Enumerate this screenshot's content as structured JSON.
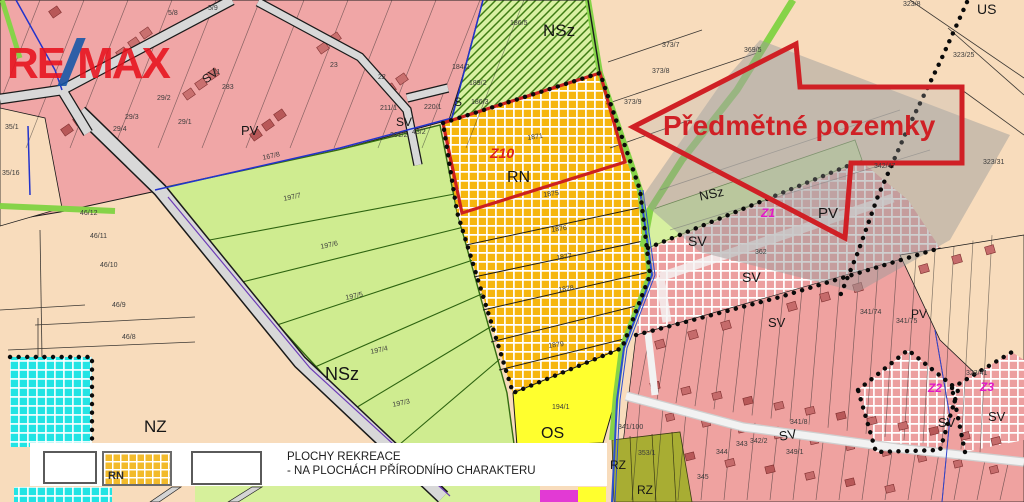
{
  "logo": {
    "re": "RE",
    "slash": "/",
    "max": "MAX"
  },
  "annotation": {
    "arrow_label": "Předmětné pozemky"
  },
  "legend": {
    "swatch_label": "RN",
    "title_line1": "PLOCHY REKREACE",
    "title_line2": "- NA PLOCHÁCH PŘÍRODNÍHO CHARAKTERU"
  },
  "colors": {
    "arrow_red": "#d02025",
    "boundary_red": "#cc2020",
    "logo_red": "#e8121d",
    "logo_blue": "#1456a8",
    "zone_orange": "#f6b60e",
    "zone_pink_checker": "#ec9f9f",
    "zone_residential_pink": "#efa2a0",
    "zone_green": "#cfec90",
    "zone_yellow": "#ffff2e",
    "zone_cyan": "#22e4e4",
    "zone_olive": "#a8ad33",
    "zone_tan": "#f8dcbc",
    "z_label_magenta": "#e318c8"
  },
  "zone_labels": [
    {
      "text": "NSz",
      "x": 543,
      "y": 22,
      "size": 17
    },
    {
      "text": "NSz",
      "x": 325,
      "y": 365,
      "size": 18
    },
    {
      "text": "NSz",
      "x": 698,
      "y": 190,
      "size": 13,
      "rot": -12
    },
    {
      "text": "NZ",
      "x": 144,
      "y": 418,
      "size": 17
    },
    {
      "text": "RN",
      "x": 507,
      "y": 170,
      "size": 16
    },
    {
      "text": "OS",
      "x": 541,
      "y": 426,
      "size": 16
    },
    {
      "text": "PV",
      "x": 818,
      "y": 206,
      "size": 15
    },
    {
      "text": "PV",
      "x": 911,
      "y": 308,
      "size": 12
    },
    {
      "text": "PV",
      "x": 241,
      "y": 124,
      "size": 13
    },
    {
      "text": "SV",
      "x": 688,
      "y": 234,
      "size": 14
    },
    {
      "text": "SV",
      "x": 742,
      "y": 270,
      "size": 14
    },
    {
      "text": "SV",
      "x": 768,
      "y": 316,
      "size": 13
    },
    {
      "text": "SV",
      "x": 778,
      "y": 430,
      "size": 13,
      "rot": -10
    },
    {
      "text": "SV",
      "x": 938,
      "y": 416,
      "size": 13
    },
    {
      "text": "SV",
      "x": 988,
      "y": 410,
      "size": 13
    },
    {
      "text": "SV",
      "x": 200,
      "y": 76,
      "size": 12,
      "rot": -38
    },
    {
      "text": "SV",
      "x": 396,
      "y": 116,
      "size": 12
    },
    {
      "text": "S",
      "x": 454,
      "y": 96,
      "size": 12
    },
    {
      "text": "US",
      "x": 977,
      "y": 2,
      "size": 14
    },
    {
      "text": "RZ",
      "x": 610,
      "y": 459,
      "size": 12
    },
    {
      "text": "RZ",
      "x": 637,
      "y": 484,
      "size": 12
    },
    {
      "text": "Z10",
      "x": 490,
      "y": 146,
      "size": 14,
      "color": "#dd1f1f",
      "italic": true
    },
    {
      "text": "Z1",
      "x": 761,
      "y": 207,
      "size": 12,
      "color": "#e318c8",
      "italic": true
    },
    {
      "text": "Z2",
      "x": 928,
      "y": 382,
      "size": 12,
      "color": "#e318c8",
      "italic": true
    },
    {
      "text": "Z3",
      "x": 980,
      "y": 381,
      "size": 12,
      "color": "#e318c8",
      "italic": true
    }
  ],
  "parcel_labels": [
    {
      "text": "167/8",
      "x": 262,
      "y": 155,
      "rot": -12
    },
    {
      "text": "197/7",
      "x": 283,
      "y": 196,
      "rot": -12
    },
    {
      "text": "197/6",
      "x": 320,
      "y": 244,
      "rot": -12
    },
    {
      "text": "197/5",
      "x": 345,
      "y": 295,
      "rot": -12
    },
    {
      "text": "197/4",
      "x": 370,
      "y": 349,
      "rot": -12
    },
    {
      "text": "197/3",
      "x": 392,
      "y": 402,
      "rot": -12
    },
    {
      "text": "1871",
      "x": 527,
      "y": 135,
      "rot": -8
    },
    {
      "text": "1875",
      "x": 543,
      "y": 192,
      "rot": -8
    },
    {
      "text": "1876",
      "x": 551,
      "y": 227,
      "rot": -8
    },
    {
      "text": "1877",
      "x": 556,
      "y": 255,
      "rot": -8
    },
    {
      "text": "1878",
      "x": 558,
      "y": 287,
      "rot": -8
    },
    {
      "text": "1879",
      "x": 548,
      "y": 343,
      "rot": -8
    },
    {
      "text": "194/1",
      "x": 552,
      "y": 404
    },
    {
      "text": "35/16",
      "x": 2,
      "y": 170
    },
    {
      "text": "46/12",
      "x": 80,
      "y": 210
    },
    {
      "text": "46/11",
      "x": 90,
      "y": 233
    },
    {
      "text": "46/10",
      "x": 100,
      "y": 262
    },
    {
      "text": "46/9",
      "x": 112,
      "y": 302
    },
    {
      "text": "46/8",
      "x": 122,
      "y": 334
    },
    {
      "text": "373/7",
      "x": 662,
      "y": 42
    },
    {
      "text": "373/8",
      "x": 652,
      "y": 68
    },
    {
      "text": "373/9",
      "x": 624,
      "y": 99
    },
    {
      "text": "369/5",
      "x": 744,
      "y": 47
    },
    {
      "text": "342/47",
      "x": 874,
      "y": 163
    },
    {
      "text": "323/8",
      "x": 903,
      "y": 1
    },
    {
      "text": "323/25",
      "x": 953,
      "y": 52
    },
    {
      "text": "323/31",
      "x": 983,
      "y": 159
    },
    {
      "text": "323/41",
      "x": 966,
      "y": 370
    },
    {
      "text": "5/8",
      "x": 168,
      "y": 10
    },
    {
      "text": "5/9",
      "x": 208,
      "y": 5
    },
    {
      "text": "11",
      "x": 213,
      "y": 69
    },
    {
      "text": "283",
      "x": 222,
      "y": 84
    },
    {
      "text": "29/2",
      "x": 157,
      "y": 95
    },
    {
      "text": "29/3",
      "x": 125,
      "y": 114
    },
    {
      "text": "29/1",
      "x": 178,
      "y": 119
    },
    {
      "text": "29/4",
      "x": 113,
      "y": 126
    },
    {
      "text": "35/1",
      "x": 5,
      "y": 124
    },
    {
      "text": "23",
      "x": 330,
      "y": 62
    },
    {
      "text": "22",
      "x": 378,
      "y": 74
    },
    {
      "text": "184/2",
      "x": 452,
      "y": 64
    },
    {
      "text": "189/2",
      "x": 469,
      "y": 80
    },
    {
      "text": "186/3",
      "x": 471,
      "y": 99
    },
    {
      "text": "211/1",
      "x": 380,
      "y": 105
    },
    {
      "text": "220/1",
      "x": 424,
      "y": 104
    },
    {
      "text": "201/2",
      "x": 390,
      "y": 132
    },
    {
      "text": "43/2",
      "x": 412,
      "y": 129
    },
    {
      "text": "186/5",
      "x": 510,
      "y": 20
    },
    {
      "text": "362",
      "x": 755,
      "y": 249
    },
    {
      "text": "341/74",
      "x": 860,
      "y": 309
    },
    {
      "text": "341/75",
      "x": 896,
      "y": 318
    },
    {
      "text": "341/100",
      "x": 618,
      "y": 424
    },
    {
      "text": "344",
      "x": 716,
      "y": 449
    },
    {
      "text": "343",
      "x": 736,
      "y": 441
    },
    {
      "text": "342/2",
      "x": 750,
      "y": 438
    },
    {
      "text": "345",
      "x": 697,
      "y": 474
    },
    {
      "text": "349/1",
      "x": 786,
      "y": 449
    },
    {
      "text": "353/1",
      "x": 638,
      "y": 450
    },
    {
      "text": "341/8",
      "x": 790,
      "y": 419
    }
  ]
}
